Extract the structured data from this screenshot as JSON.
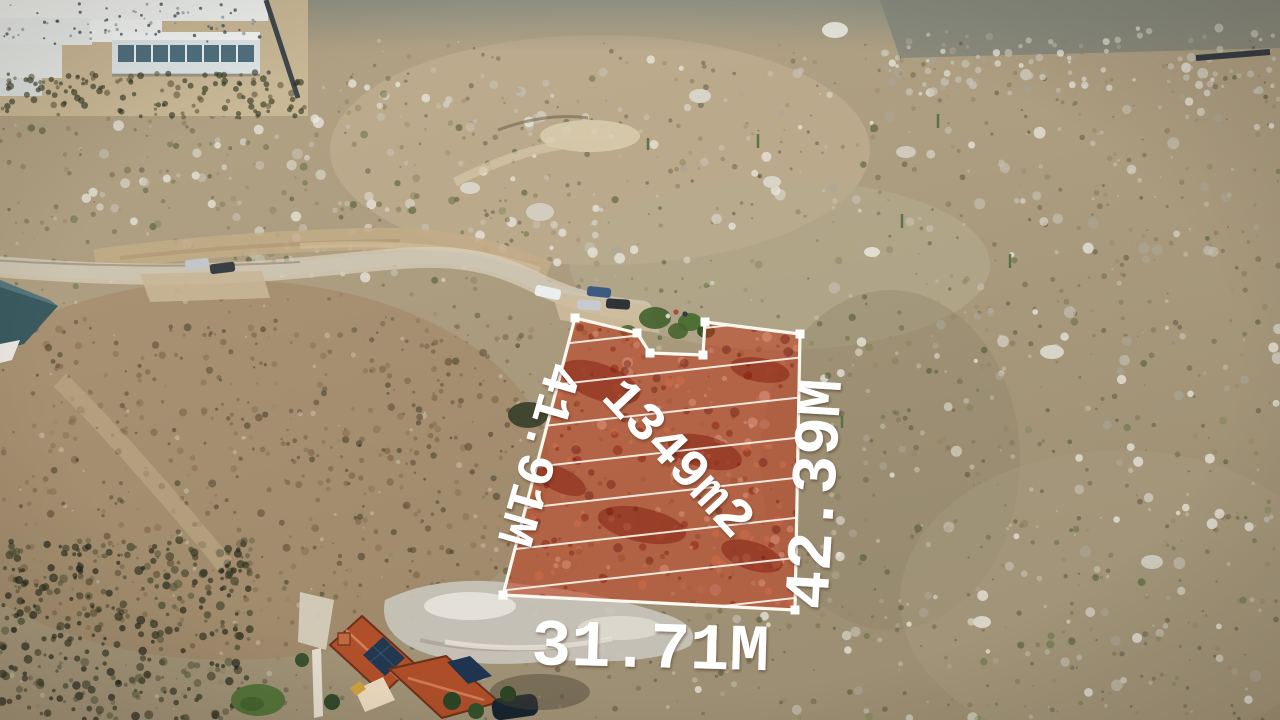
{
  "lot": {
    "area": "1349m2",
    "side_left": "41.91M",
    "side_right": "42.39M",
    "side_bottom": "31.71M"
  },
  "colors": {
    "lot_fill": "#bf3a1c",
    "lot_outline": "#fbf8f0",
    "label_text": "#ffffff"
  }
}
